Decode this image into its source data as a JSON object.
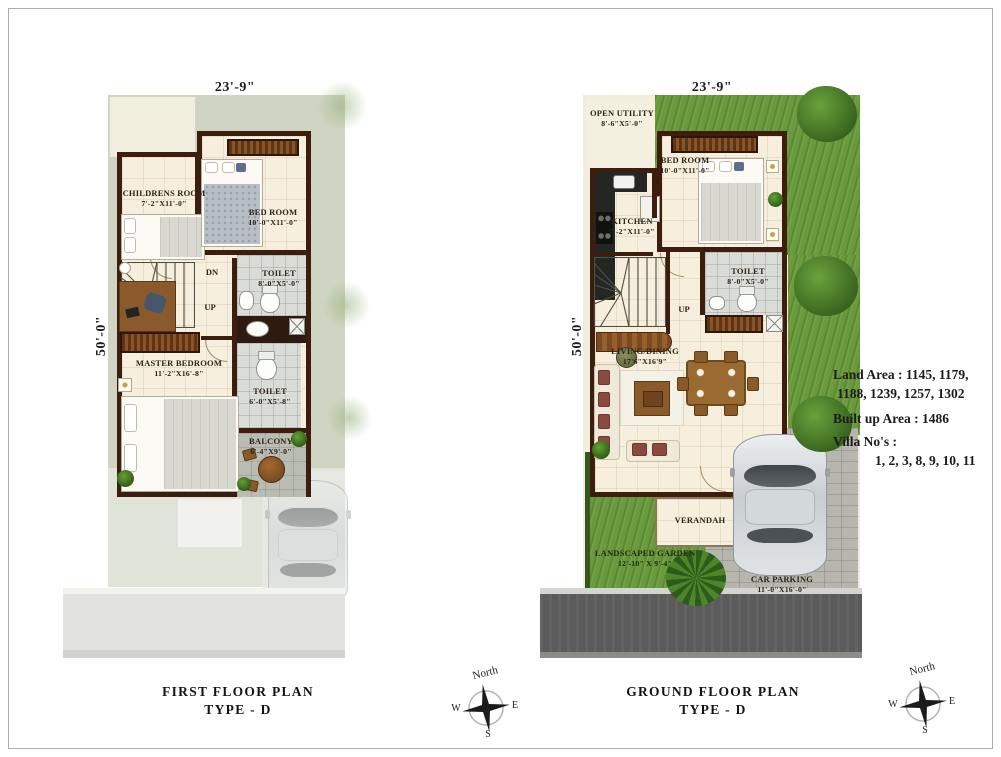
{
  "sheet": {
    "background": "#ffffff",
    "frame_color": "#a9aeae"
  },
  "first_floor": {
    "title_line1": "FIRST FLOOR PLAN",
    "title_line2": "TYPE  - D",
    "dim_width": "23'-9\"",
    "dim_height": "50'-0\"",
    "stairs": {
      "dn": "DN",
      "up": "UP"
    },
    "rooms": {
      "childrens_room": {
        "name": "CHILDRENS ROOM",
        "size": "7'-2\"X11'-0\""
      },
      "bed_room": {
        "name": "BED ROOM",
        "size": "10'-0\"X11'-0\""
      },
      "toilet_top": {
        "name": "TOILET",
        "size": "8'-0\"X5'-0\""
      },
      "master_bedroom": {
        "name": "MASTER BEDROOM",
        "size": "11'-2\"X16'-8\""
      },
      "toilet_bottom": {
        "name": "TOILET",
        "size": "6'-0\"X5'-8\""
      },
      "balcony": {
        "name": "BALCONY",
        "size": "6'-4\"X9'-0\""
      }
    }
  },
  "ground_floor": {
    "title_line1": "GROUND FLOOR PLAN",
    "title_line2": "TYPE  - D",
    "dim_width": "23'-9\"",
    "dim_height": "50'-0\"",
    "stairs": {
      "up": "UP"
    },
    "rooms": {
      "open_utility": {
        "name": "OPEN UTILITY",
        "size": "8'-6\"X5'-0\""
      },
      "kitchen": {
        "name": "KITCHEN",
        "size": "7'-2\"X11'-0\""
      },
      "bed_room": {
        "name": "BED ROOM",
        "size": "10'-0\"X11'-0\""
      },
      "toilet": {
        "name": "TOILET",
        "size": "8'-0\"X5'-0\""
      },
      "living_dining": {
        "name": "LIVING/DINING",
        "size": "17'6\"X16'9\""
      },
      "verandah": {
        "name": "VERANDAH"
      },
      "landscaped_garden": {
        "name": "LANDSCAPED GARDEN",
        "size": "12'-10\" X 9'-4\""
      },
      "car_parking": {
        "name": "CAR PARKING",
        "size": "11'-0\"X16'-0\""
      }
    }
  },
  "info_panel": {
    "land_area_line1": "Land Area : 1145, 1179,",
    "land_area_line2": "1188, 1239, 1257, 1302",
    "built_up_area": "Built up Area : 1486",
    "villa_label": "Villa No's :",
    "villa_numbers": "1, 2, 3, 8, 9, 10, 11"
  },
  "compass": {
    "north": "North",
    "east": "E",
    "west": "W",
    "south": "S"
  },
  "colors": {
    "wall": "#3c1d0e",
    "floor": "#f7efdd",
    "grass": "#6b9a3e",
    "toilet_floor": "#dadcd7",
    "parking": "#b6b6ae",
    "road_dark": "#5b5b5b",
    "plot_sage": "#cfd5c2"
  }
}
